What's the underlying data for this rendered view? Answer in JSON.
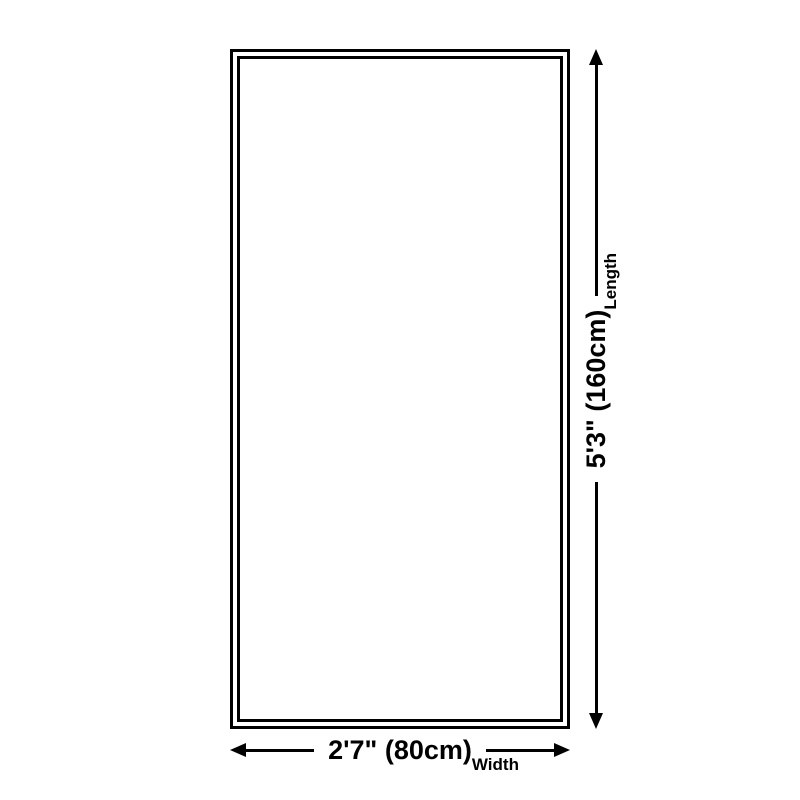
{
  "canvas": {
    "background": "#ffffff"
  },
  "product_box": {
    "border_color": "#000000",
    "fill_color": "#ffffff",
    "border_style": "double"
  },
  "dimensions": {
    "length": {
      "value": "5'3\" (160cm)",
      "label": "Length"
    },
    "width": {
      "value": "2'7\" (80cm)",
      "label": "Width"
    }
  },
  "colors": {
    "line": "#000000",
    "text": "#000000"
  }
}
